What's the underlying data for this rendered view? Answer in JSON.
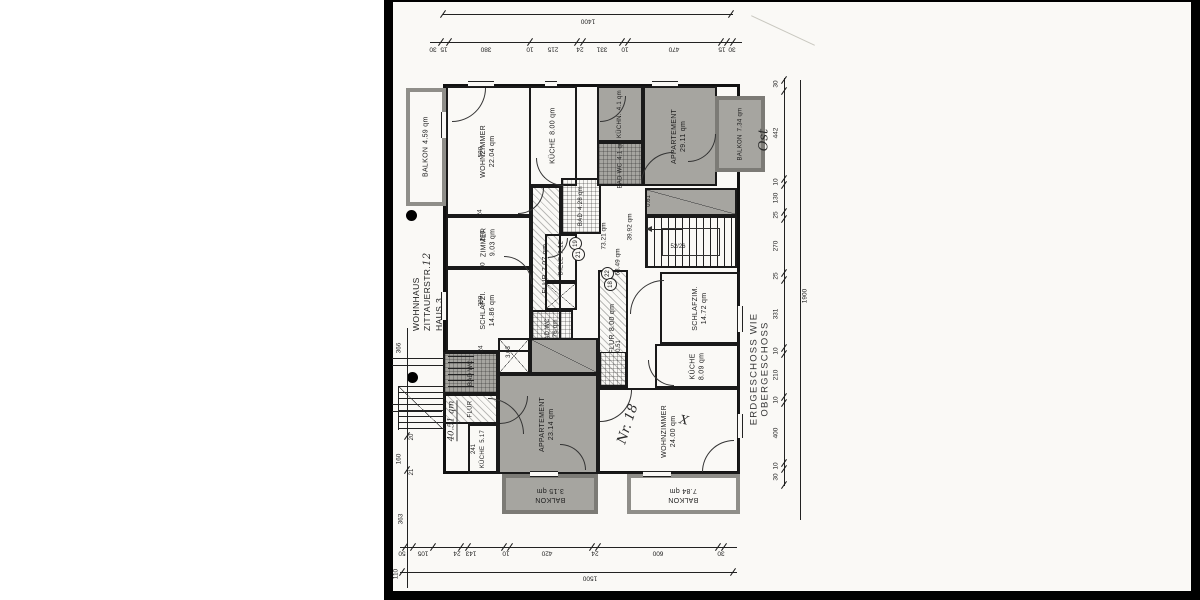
{
  "title_block": {
    "line1": "WOHNHAUS",
    "line2": "ZITTAUERSTR.",
    "house_no_hand": "12",
    "line3": "HAUS 3"
  },
  "notes": {
    "floor_note": "ERDGESCHOSS WIE OBERGESCHOSS",
    "orientation_hand": "Ost",
    "apartment_no_hand": "Nr. 18",
    "x_mark_hand": "X",
    "stair_spec": "52/26",
    "area_total_hand": "40.51 qm"
  },
  "rooms": {
    "balkon_nw": {
      "label": "BALKON",
      "area": "4.59 qm"
    },
    "wohnzimmer_nw": {
      "label": "WOHNZIMMER",
      "area": "22.04 qm"
    },
    "kueche_nw": {
      "label": "KÜCHE",
      "area": "8.00 qm"
    },
    "zimmer": {
      "label": "ZIMMER",
      "area": "9.03 qm"
    },
    "schlafzi": {
      "label": "SCHLAFZI.",
      "area": "14.86 qm"
    },
    "flur19": {
      "label": "FLUR",
      "area": "7.07 qm"
    },
    "bad428": {
      "label": "BAD",
      "area": "4.28 qm"
    },
    "diele": {
      "label": "DIELE",
      "area": "2.12"
    },
    "badwc476": {
      "label": "BAD WC",
      "area": "4.76 qm"
    },
    "kuechn_ne": {
      "label": "KÜCHN.",
      "area": "4.1 qm"
    },
    "badwc_ne": {
      "label": "BAD WC",
      "area": "4.1 qm"
    },
    "appartement_ne": {
      "label": "APPARTEMENT",
      "area": "29.11 qm"
    },
    "balkon_ne": {
      "label": "BALKON",
      "area": "7.34 qm"
    },
    "schlafzim18": {
      "label": "SCHLAFZIM.",
      "area": "14.72 qm"
    },
    "kueche18": {
      "label": "KÜCHE",
      "area": "8.09 qm"
    },
    "wohnzimmer18": {
      "label": "WOHNZIMMER",
      "area": "24.00 qm"
    },
    "flur18": {
      "label": "FLUR",
      "area": "8.00 qm"
    },
    "appartement22": {
      "label": "APPARTEMENT",
      "area": "23.14 qm"
    },
    "balkon22": {
      "label": "BALKON",
      "area": "3.15 qm"
    },
    "balkon18": {
      "label": "BALKON",
      "area": "7.84 qm"
    },
    "kueche_entry": {
      "label": "KÜCHE",
      "area": "5.17"
    },
    "badwc_entry": {
      "label": "BAD WC",
      "area": ""
    },
    "flur_entry": {
      "label": "FLUR",
      "area": ""
    }
  },
  "annotations": {
    "a7321": "73.21 qm",
    "a3992": "39.92 qm",
    "a6349": "63.49 qm",
    "a051": "0.51",
    "a061": "0.61",
    "a303": "3.03",
    "a241": "241"
  },
  "units": {
    "u19": "19",
    "u21": "21",
    "u22": "22",
    "u18": "18"
  },
  "dims": {
    "top": {
      "overall": "1400",
      "e15l": "15",
      "e30l": "30",
      "s380": "380",
      "s10a": "10",
      "s215": "215",
      "s24": "24",
      "s331": "331",
      "s10b": "10",
      "s470": "470",
      "e15r": "15",
      "e30r": "30"
    },
    "right": {
      "overall": "1900",
      "r30a": "30",
      "r442": "442",
      "r10a": "10",
      "r130": "130",
      "r25a": "25",
      "r270": "270",
      "r25b": "25",
      "r331": "331",
      "r10b": "10",
      "r210": "210",
      "r10c": "10",
      "r400": "400",
      "r10d": "10",
      "r30b": "30"
    },
    "bottom": {
      "overall": "1500",
      "b50": "50",
      "b105": "105",
      "b24a": "24",
      "b143": "143",
      "b10": "10",
      "b420": "420",
      "b24b": "24",
      "b600": "600",
      "b30": "30"
    },
    "left": {
      "l366": "366",
      "l20": "20",
      "l160": "160",
      "l21": "21",
      "l363": "363",
      "l110": "110"
    },
    "interior": {
      "i580": "580",
      "i24a": "24",
      "i210": "210",
      "i10": "10",
      "i380": "380",
      "i24b": "24"
    }
  }
}
